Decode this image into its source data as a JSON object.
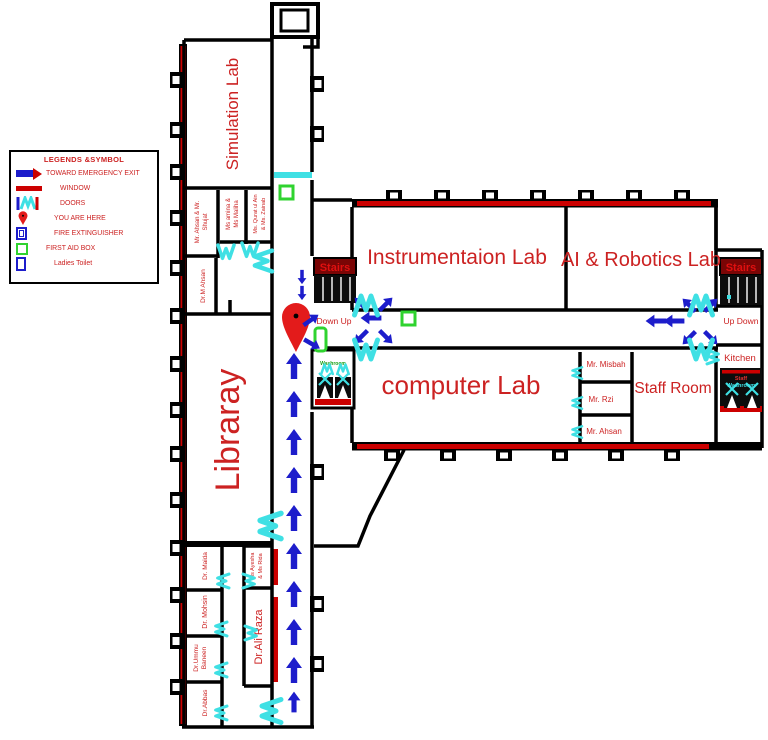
{
  "legend": {
    "title": "LEGENDS &SYMBOL",
    "items": [
      {
        "name": "toward-emergency-exit",
        "label": "TOWARD EMERGENCY EXIT"
      },
      {
        "name": "window",
        "label": "WINDOW"
      },
      {
        "name": "doors",
        "label": "DOORS"
      },
      {
        "name": "you-are-here",
        "label": "YOU ARE HERE"
      },
      {
        "name": "fire-extinguisher",
        "label": "FIRE EXTINGUISHER"
      },
      {
        "name": "first-aid-box",
        "label": "FIRST AID BOX"
      },
      {
        "name": "ladies-toilet",
        "label": "Ladies Toilet"
      }
    ]
  },
  "rooms": {
    "simulation_lab": "Simulation Lab",
    "instrumentation_lab": "Instrumentaion Lab",
    "ai_robotics_lab": "AI & Robotics Lab",
    "computer_lab": "computer Lab",
    "staff_room": "Staff Room",
    "library": "Libraray",
    "kitchen": "Kitchen",
    "staff_washroom_l1": "Staff",
    "staff_washroom_l2": "Washroom",
    "washroom_left": "Washroom",
    "ahsan_shujat_l1": "Mr. Ahsan & Mr.",
    "ahsan_shujat_l2": "Shujat",
    "amina_maliha_l1": "Ms amina &",
    "amina_maliha_l2": "Ms Maliha",
    "qurat_zainab_l1": "Ms. Qurat ul Ain",
    "qurat_zainab_l2": "& Ms. Zainab",
    "m_ahsan": "Dr.M Ahsan",
    "misbah": "Mr. Misbah",
    "rzi": "Mr. Rzi",
    "ahsan": "Mr. Ahsan",
    "maida": "Dr. Maida",
    "mohsin": "Dr. Mohsin",
    "ummu_l1": "Dr.Ummu",
    "ummu_l2": "Baneen",
    "abbas": "Dr.Abbas",
    "ayesha_l1": "Ms Ayesha",
    "ayesha_l2": "& Ms Rida",
    "ali_raza": "Dr.Ali Raza"
  },
  "stairs": {
    "left_label": "Stairs",
    "left_dir": "Down Up",
    "right_label": "Stairs",
    "right_dir": "Up Down"
  },
  "colors": {
    "wall": "#000000",
    "window": "#cc0000",
    "room_label": "#cc2222",
    "exit_arrow": "#1d1dcb",
    "door": "#3fe0e4",
    "first_aid": "#2fd32f",
    "pin": "#e31b1b",
    "washroom_label_green": "#18a018"
  }
}
